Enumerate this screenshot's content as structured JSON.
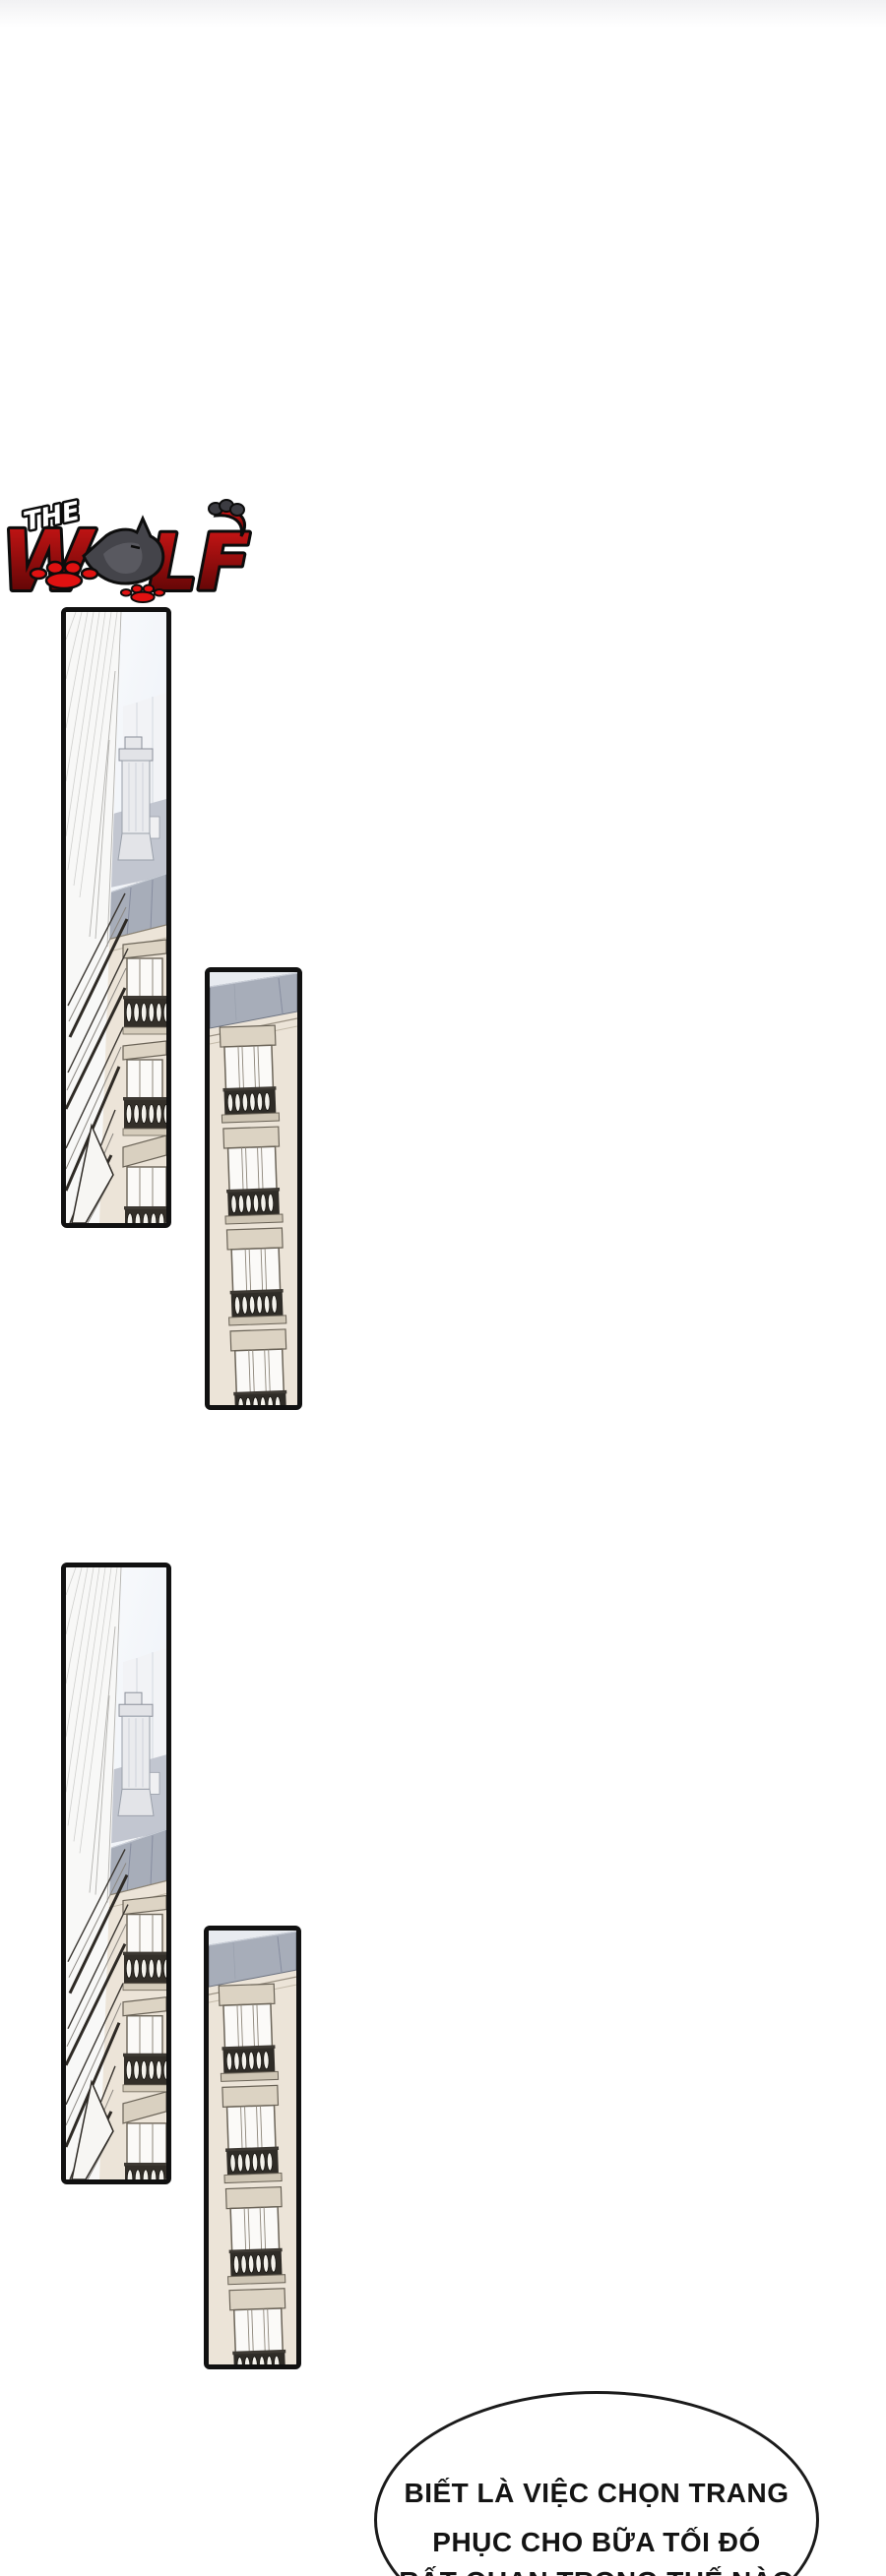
{
  "page": {
    "title": "The Wolf — comic page",
    "background": "#ffffff",
    "top_fade_color": "#f1f1f3"
  },
  "logo": {
    "the": "THE",
    "w": "W",
    "lf": "LF",
    "full_title": "THE WOLF",
    "colors": {
      "red": "#d51717",
      "dark_red": "#4a0202",
      "outline": "#0c0c0c",
      "wolf_gray": "#44444a",
      "paw_red": "#e01111",
      "the_fill": "#ffffff"
    }
  },
  "panels": [
    {
      "id": "panel-1",
      "alt": "Low-angle view up a white building corner with chimney, slate roof band and cream facade with balcony windows"
    },
    {
      "id": "panel-2",
      "alt": "Tilted cream building facade with slate roof band and stacked French windows with balustrade balconies"
    },
    {
      "id": "panel-3",
      "alt": "Repeated low-angle view up the white building corner with chimney and balcony windows"
    },
    {
      "id": "panel-4",
      "alt": "Repeated tilted cream facade with slate roof and balcony windows"
    }
  ],
  "speech_bubble": {
    "line1": "BIẾT LÀ VIỆC CHỌN TRANG",
    "line2": "PHỤC CHO BỮA TỐI ĐÓ",
    "line3_cut_off": "RẤT QUAN TRỌNG THẾ NÀO"
  },
  "palette": {
    "panel_border": "#111111",
    "sky_top": "#fcfdfe",
    "sky_bottom": "#e8edf5",
    "facade_white": "#f8f8f7",
    "facade_cream": "#ece4d8",
    "roof_slate": "#a7adb9",
    "window_frame": "#6b6458",
    "window_cap": "#dcd3c3",
    "balustrade_dark": "#2f2c27",
    "bubble_border": "#1b1b1b"
  }
}
